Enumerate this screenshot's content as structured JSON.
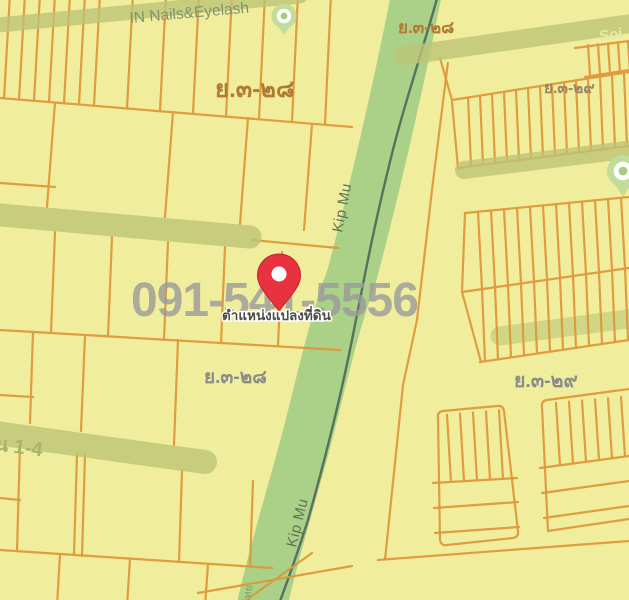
{
  "map": {
    "watermark": "091-541-5556",
    "pin_caption": "ตำแหน่งแปลงที่ดิน",
    "labels": {
      "poi_top": "IN Nails&Eyelash",
      "soi": "Soi",
      "kip_mu_upper": "Kip Mu",
      "kip_mu_lower": "Kip Mu",
      "band_bottom_left": "น 1-4",
      "canal_bottom": "ไทย",
      "zone_top_left": "ย.๓-๒๘",
      "zone_top_canal": "ย.๓-๒๘",
      "zone_mid_left": "ย.๓-๒๘",
      "zone_top_right": "ย.๓-๒๙",
      "zone_mid_right": "ย.๓-๒๙"
    },
    "colors": {
      "background": "#f0ed9d",
      "parcel_line": "#de9738",
      "canal": "#abd189",
      "stream": "#4b6759",
      "road_band": "#bdc476",
      "watermark": "#9b9b9b",
      "pin": "#e8323f",
      "pin_stroke": "#c2202e",
      "label_orange": "#b07a33",
      "label_brown": "#9b8560",
      "label_gray": "#8c8c8c",
      "poi_text": "#7d8d72",
      "road_text": "#5e7457",
      "band_text": "#a3b66e",
      "soi_text": "#e6eba6",
      "caption_fill": "#4d4d4d",
      "poi_green": "#c2dc9b",
      "poi_center": "#a7cc7f"
    }
  }
}
